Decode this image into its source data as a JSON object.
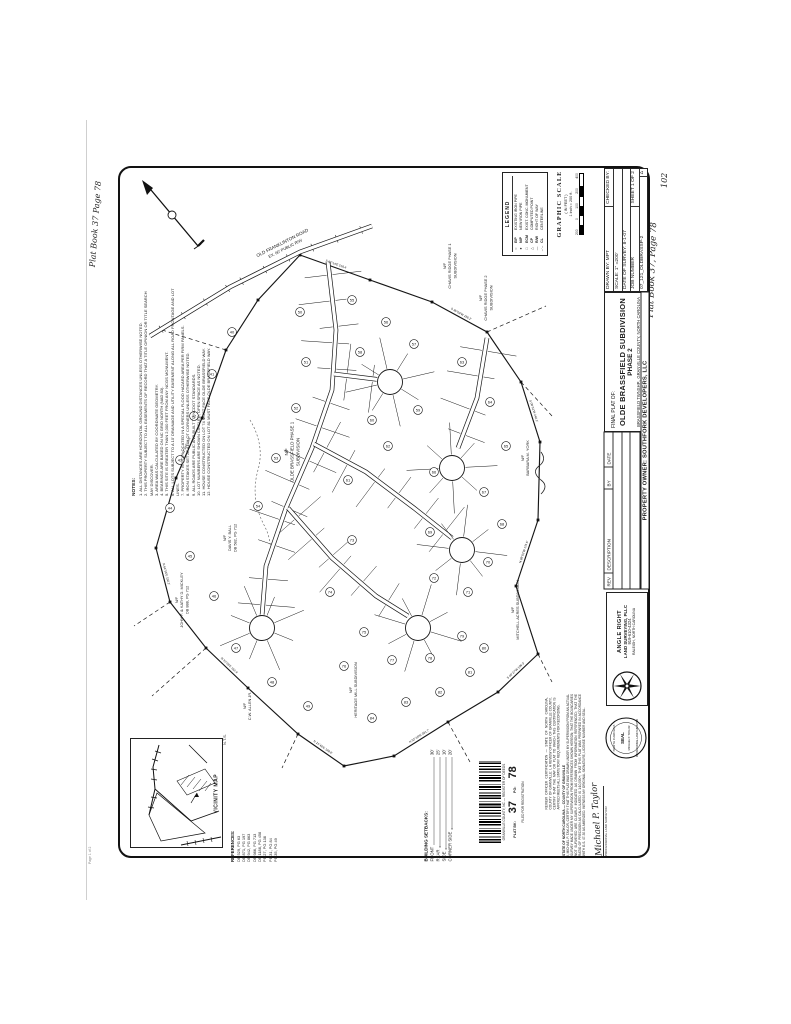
{
  "page": {
    "handwritten_top_left": "Plat Book 37 Page 78",
    "handwritten_right": "Plat Book 37, Page 78",
    "page_number": "102",
    "corner_note": "Page 1 of 2"
  },
  "title_block": {
    "final_plat_label": "FINAL PLAT OF:",
    "title": "OLDE BRASSFIELD SUBDIVISION",
    "phase": "PHASE 2",
    "location": "BRASSFIELD TWNSHP., GRANVILLE COUNTY, NORTH CAROLINA",
    "owner": "PROPERTY OWNER: SOUTHFORK DEVELOPERS, LLC",
    "drawn_by": "DRAWN BY: MPT",
    "checked_by": "CHECKED BY:",
    "scale": "SCALE: 1\" =200'",
    "date_of_survey": "DATE OF SURVEY: 8-1-07",
    "job_number_label": "JOB NUMBER",
    "sheet": "SHEET 1 OF 2",
    "job_number": "07_121_OLDBRASSP-2",
    "rev_headers": [
      "REV",
      "DESCRIPTION",
      "BY",
      "DATE"
    ],
    "triangle": "Δ"
  },
  "graphic_scale": {
    "title": "GRAPHIC SCALE",
    "in_feet": "( IN FEET )",
    "ratio": "1 inch = 200 ft.",
    "ticks": [
      "200",
      "0",
      "100",
      "200",
      "400"
    ]
  },
  "surveyor": {
    "firm1": "ANGLE RIGHT",
    "firm2": "LAND SURVEYING, PLLC",
    "phone": "919-610-4324",
    "address": "RALEIGH, NORTH CAROLINA",
    "seal_top": "NORTH CAROLINA",
    "seal_mid": "SEAL",
    "seal_name": "MICHAEL P. TAYLOR",
    "seal_bottom": "PROFESSIONAL LAND SURVEYOR"
  },
  "certificates": {
    "cert1_title": "STATE OF NORTH CAROLINA — COUNTY OF GRANVILLE",
    "cert1": "I, MICHAEL P. TAYLOR, CERTIFY THAT THIS PLAT WAS DRAWN UNDER MY SUPERVISION FROM AN ACTUAL SURVEY MADE UNDER MY SUPERVISION FROM REFERENCES SHOWN HEREON; THAT THE BOUNDARIES NOT SURVEYED ARE CLEARLY INDICATED AS DRAWN FROM INFORMATION REFERENCED; THAT THE RATIO OF PRECISION AS CALCULATED IS 1:10,000+; THAT THIS PLAT WAS PREPARED IN ACCORDANCE WITH G.S. 47-30 AS AMENDED. WITNESS MY ORIGINAL SIGNATURE, LICENSE NUMBER AND SEAL.",
    "signature": "Michael P. Taylor",
    "signature_title": "PROFESSIONAL LAND SURVEYOR",
    "cert2": "REVIEW OFFICER CERTIFICATION — STATE OF NORTH CAROLINA, COUNTY OF GRANVILLE: I, A REVIEW OFFICER OF GRANVILLE COUNTY, CERTIFY THAT THE MAP OR PLAT TO WHICH THIS CERTIFICATION IS AFFIXED MEETS ALL STATUTORY REQUIREMENTS FOR RECORDING."
  },
  "notes": {
    "heading": "NOTES:",
    "items": [
      "1. ALL DISTANCES ARE HORIZONTAL GROUND DISTANCES UNLESS OTHERWISE NOTED.",
      "2. THIS PROPERTY SUBJECT TO ALL EASEMENTS OF RECORD THAT A TITLE OPINION OR TITLE SEARCH MAY DISCOVER.",
      "3. AREA WAS CALCULATED BY COORDINATE GEOMETRY.",
      "4. BEARINGS ARE BASED ON NC GRID NORTH (NAD 83).",
      "5. THIS SITE IS GREATER THAN 2,000 FEET FROM ANY NCGS MONUMENT.",
      "6. ALL LOTS SUBJECT TO A 10' DRAINAGE AND UTILITY EASEMENT ALONG ALL ROAD FRONTAGE AND LOT LINES.",
      "7. PROPERTY IS NOT LOCATED IN A SPECIAL FLOOD HAZARD AREA PER FIRM PANELS.",
      "8. IRON STAKES SET AT ALL LOT CORNERS UNLESS OTHERWISE NOTED.",
      "9. ALL ROADS ARE PUBLIC AND BUILT TO NCDOT STANDARDS.",
      "10. LOT NUMBERS ARE SHOWN CIRCLED; OPEN SPACE AS NOTED.",
      "11. HOUSE CONSTRUCTED ON LOT 74 MUST FACE OLDE BRASSFIELD WAY.",
      "12. HOUSE CONSTRUCTED ON LOT 81 MUST FACE OLDE BRASSFIELD WAY."
    ]
  },
  "legend": {
    "heading": "LEGEND",
    "entries": [
      {
        "sym": "○",
        "abbr": "EIP",
        "desc": "EXISTING IRON PIPE"
      },
      {
        "sym": "●",
        "abbr": "NIP",
        "desc": "NEW IRON PIPE"
      },
      {
        "sym": "□",
        "abbr": "ECM",
        "desc": "EXIST. CONC. MONUMENT"
      },
      {
        "sym": "△",
        "abbr": "CP",
        "desc": "COMPUTED POINT"
      },
      {
        "sym": "—",
        "abbr": "R/W",
        "desc": "RIGHT OF WAY"
      },
      {
        "sym": "–·–",
        "abbr": "CL",
        "desc": "CENTERLINE"
      }
    ]
  },
  "vicinity": {
    "label": "VICINITY MAP",
    "nts": "N.T.S."
  },
  "references": {
    "heading": "REFERENCES:",
    "items": [
      "DB 529, PG 63",
      "DB 871, PG 197",
      "DB 942, PG 863",
      "DB 986, PG 713",
      "DB 1188, PG 458",
      "PB 27, PG 138",
      "PB 31, PG 84",
      "PB 35, PG 49"
    ]
  },
  "setbacks": {
    "heading": "BUILDING SETBACKS:",
    "rows": [
      [
        "FRONT",
        "30'"
      ],
      [
        "REAR",
        "25'"
      ],
      [
        "SIDE",
        "10'"
      ],
      [
        "CORNER SIDE",
        "20'"
      ]
    ]
  },
  "recording": {
    "county_line": "GRANVILLE COUNTY, NC — REGISTER OF DEEDS",
    "filed_line": "FILED FOR REGISTRATION",
    "book_label": "PLAT BK:",
    "book": "37",
    "page_label": "PG:",
    "page": "78"
  },
  "map": {
    "road_name": "OLD FRANKLINTON ROAD",
    "road_rw": "EX. 60' PUBLIC R/W",
    "labels": [
      {
        "lines": [
          "N/F",
          "OLDE BRASSFIELD PHASE 1",
          "SUBDIVISION"
        ],
        "x": 288,
        "y": 452,
        "rot": -90,
        "size": 4.4
      },
      {
        "lines": [
          "N/F",
          "CHAVIS RIDGE PHASE 1",
          "SUBDIVISION"
        ],
        "x": 446,
        "y": 266,
        "rot": -90,
        "size": 3.9
      },
      {
        "lines": [
          "N/F",
          "CHAVIS RIDGE PHASE 2",
          "SUBDIVISION"
        ],
        "x": 482,
        "y": 298,
        "rot": -90,
        "size": 3.9
      },
      {
        "lines": [
          "N/F",
          "BARBARA M. YORK"
        ],
        "x": 524,
        "y": 458,
        "rot": -90,
        "size": 3.9
      },
      {
        "lines": [
          "N/F",
          "DAVIS Y. BALL",
          "DB 582, PG 712"
        ],
        "x": 226,
        "y": 538,
        "rot": -90,
        "size": 3.9
      },
      {
        "lines": [
          "N/F",
          "JOHN F. & KATHY D. MICKLEY",
          "DB 888, PG 712"
        ],
        "x": 178,
        "y": 600,
        "rot": -90,
        "size": 3.9
      },
      {
        "lines": [
          "N/F",
          "MITCHELL ACRES SUBDIVISION"
        ],
        "x": 514,
        "y": 610,
        "rot": -90,
        "size": 3.9
      },
      {
        "lines": [
          "N/F",
          "HERITAGE MILL SUBDIVISION"
        ],
        "x": 352,
        "y": 690,
        "rot": -90,
        "size": 3.9
      },
      {
        "lines": [
          "N/F",
          "C.W. ALLEN JR."
        ],
        "x": 246,
        "y": 706,
        "rot": -90,
        "size": 3.9
      }
    ],
    "bearings": [
      "S 62°14'E  218.4'",
      "S 35°08'W  186.2'",
      "S 08°51'W  240.1'",
      "N 88°02'W  175.6'",
      "S 46°27'W  198.3'",
      "N 52°19'W  201.7'",
      "N 21°46'E  188.9'",
      "N 33°28'E  162.4'",
      "N 64°55'E  150.2'",
      "N 12°34'E  96.8'"
    ],
    "lots": [
      {
        "n": 40,
        "x": 232,
        "y": 332
      },
      {
        "n": 41,
        "x": 212,
        "y": 374
      },
      {
        "n": 42,
        "x": 194,
        "y": 416
      },
      {
        "n": 43,
        "x": 180,
        "y": 460
      },
      {
        "n": 44,
        "x": 170,
        "y": 508
      },
      {
        "n": 45,
        "x": 190,
        "y": 556
      },
      {
        "n": 46,
        "x": 214,
        "y": 596
      },
      {
        "n": 47,
        "x": 236,
        "y": 648
      },
      {
        "n": 48,
        "x": 272,
        "y": 682
      },
      {
        "n": 49,
        "x": 308,
        "y": 706
      },
      {
        "n": 50,
        "x": 300,
        "y": 312
      },
      {
        "n": 51,
        "x": 306,
        "y": 362
      },
      {
        "n": 52,
        "x": 296,
        "y": 408
      },
      {
        "n": 53,
        "x": 276,
        "y": 458
      },
      {
        "n": 54,
        "x": 258,
        "y": 506
      },
      {
        "n": 55,
        "x": 352,
        "y": 300
      },
      {
        "n": 56,
        "x": 386,
        "y": 322
      },
      {
        "n": 57,
        "x": 414,
        "y": 344
      },
      {
        "n": 58,
        "x": 360,
        "y": 352
      },
      {
        "n": 59,
        "x": 418,
        "y": 410
      },
      {
        "n": 60,
        "x": 372,
        "y": 420
      },
      {
        "n": 61,
        "x": 348,
        "y": 480
      },
      {
        "n": 62,
        "x": 388,
        "y": 446
      },
      {
        "n": 63,
        "x": 462,
        "y": 362
      },
      {
        "n": 64,
        "x": 490,
        "y": 402
      },
      {
        "n": 65,
        "x": 506,
        "y": 446
      },
      {
        "n": 66,
        "x": 434,
        "y": 472
      },
      {
        "n": 67,
        "x": 484,
        "y": 492
      },
      {
        "n": 68,
        "x": 502,
        "y": 524
      },
      {
        "n": 69,
        "x": 430,
        "y": 532
      },
      {
        "n": 70,
        "x": 488,
        "y": 562
      },
      {
        "n": 71,
        "x": 468,
        "y": 592
      },
      {
        "n": 72,
        "x": 434,
        "y": 578
      },
      {
        "n": 73,
        "x": 352,
        "y": 540
      },
      {
        "n": 74,
        "x": 330,
        "y": 592
      },
      {
        "n": 75,
        "x": 364,
        "y": 632
      },
      {
        "n": 76,
        "x": 344,
        "y": 666
      },
      {
        "n": 77,
        "x": 392,
        "y": 660
      },
      {
        "n": 78,
        "x": 430,
        "y": 658
      },
      {
        "n": 79,
        "x": 462,
        "y": 636
      },
      {
        "n": 80,
        "x": 484,
        "y": 648
      },
      {
        "n": 81,
        "x": 470,
        "y": 672
      },
      {
        "n": 82,
        "x": 440,
        "y": 692
      },
      {
        "n": 83,
        "x": 406,
        "y": 702
      },
      {
        "n": 84,
        "x": 372,
        "y": 718
      }
    ]
  }
}
